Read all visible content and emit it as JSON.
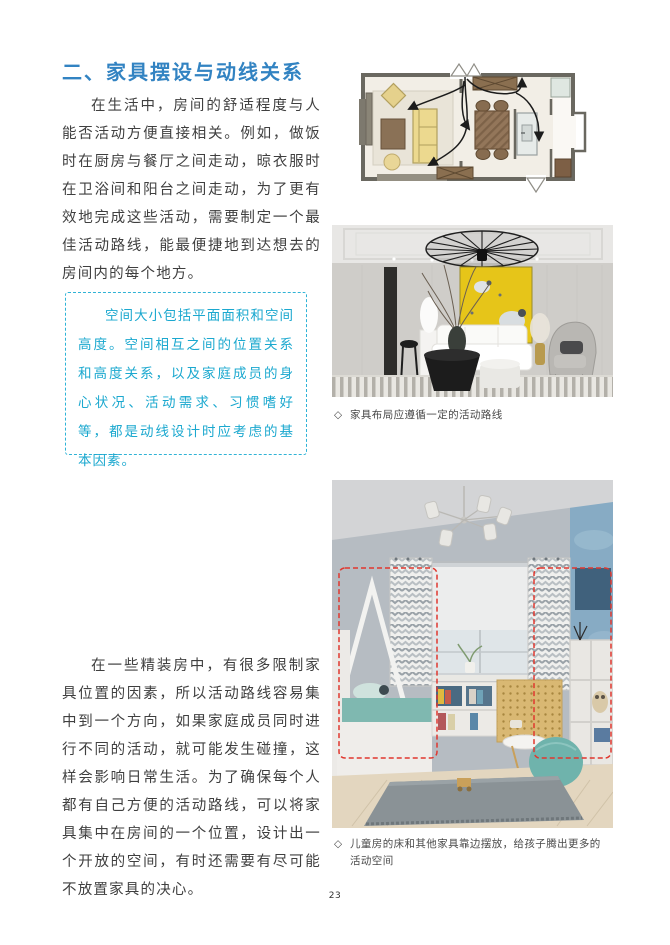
{
  "article": {
    "heading": "二、家具摆设与动线关系",
    "paragraphs": [
      "在生活中，房间的舒适程度与人能否活动方便直接相关。例如，做饭时在厨房与餐厅之间走动，晾衣服时在卫浴间和阳台之间走动，为了更有效地完成这些活动，需要制定一个最佳活动路线，能最便捷地到达想去的房间内的每个地方。",
      "在一些精装房中，有很多限制家具位置的因素，所以活动路线容易集中到一个方向，如果家庭成员同时进行不同的活动，就可能发生碰撞，这样会影响日常生活。为了确保每个人都有自己方便的活动路线，可以将家具集中在房间的一个位置，设计出一个开放的空间，有时还需要有尽可能不放置家具的决心。"
    ],
    "callout": "空间大小包括平面面积和空间高度。空间相互之间的位置关系和高度关系，以及家庭成员的身心状况、活动需求、习惯嗜好等，都是动线设计时应考虑的基本因素。",
    "page_number": "23"
  },
  "captions": {
    "living": {
      "marker": "◇",
      "text": "家具布局应遵循一定的活动路线"
    },
    "kids": {
      "marker": "◇",
      "text": "儿童房的床和其他家具靠边摆放，给孩子腾出更多的活动空间"
    }
  },
  "colors": {
    "heading_blue": "#3283c2",
    "callout_cyan": "#1ba8cf",
    "callout_border": "#2fb3d6",
    "body_text": "#3f3f3f",
    "highlight_red": "#e0372e",
    "artwork_yellow": "#e6c519",
    "plan_sofa_yellow": "#ecd98f",
    "bean_bag_teal": "#6fb3ac"
  }
}
